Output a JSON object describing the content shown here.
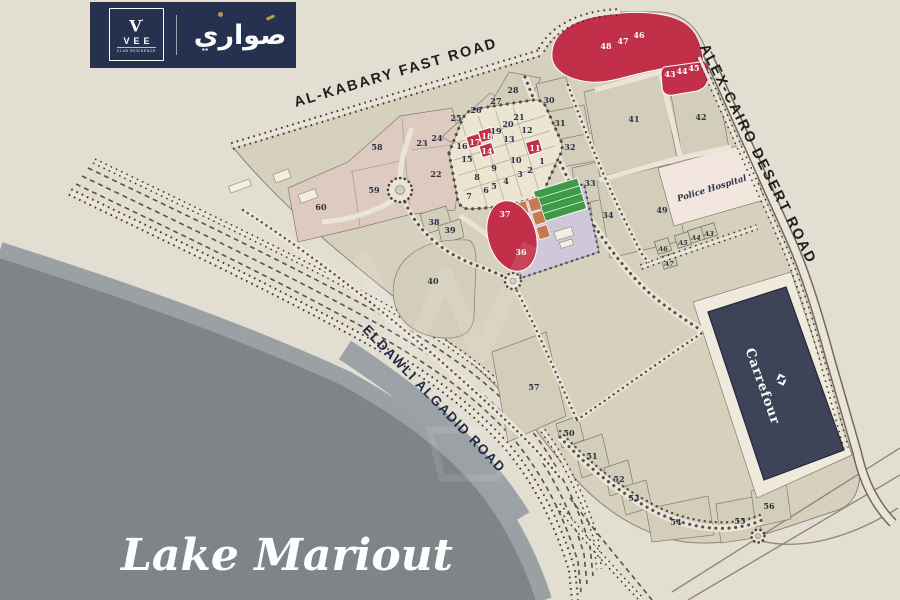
{
  "brand": {
    "vee_mark": "V",
    "vee_name": "VEE",
    "vee_subtitle": "CLUB RESIDENCE",
    "arabic_logo": "صواري"
  },
  "map": {
    "lake_label": "Lake Mariout",
    "roads": {
      "top": "AL-KABARY FAST ROAD",
      "right": "ALEX-CAIRO DESERT ROAD",
      "coast": "ELDAWLI ALGADID ROAD"
    },
    "landmarks": {
      "hospital": "Police Hospital",
      "hypermarket": "Carrefour"
    },
    "colors": {
      "highlight_red": "#c22f49",
      "plot_number_navy": "#2d3147",
      "lake_gray": "#7e8488",
      "land_beige": "#e3ded2",
      "building_navy": "#3e4457"
    },
    "plots": [
      {
        "id": "1",
        "x": 542,
        "y": 161
      },
      {
        "id": "2",
        "x": 530,
        "y": 170
      },
      {
        "id": "3",
        "x": 520,
        "y": 174
      },
      {
        "id": "4",
        "x": 506,
        "y": 181
      },
      {
        "id": "5",
        "x": 494,
        "y": 186
      },
      {
        "id": "6",
        "x": 486,
        "y": 190
      },
      {
        "id": "7",
        "x": 469,
        "y": 196
      },
      {
        "id": "8",
        "x": 477,
        "y": 177
      },
      {
        "id": "9",
        "x": 494,
        "y": 168
      },
      {
        "id": "10",
        "x": 516,
        "y": 160
      },
      {
        "id": "11",
        "x": 535,
        "y": 148,
        "red": true
      },
      {
        "id": "12",
        "x": 527,
        "y": 130
      },
      {
        "id": "13",
        "x": 509,
        "y": 139
      },
      {
        "id": "14",
        "x": 487,
        "y": 151,
        "red": true
      },
      {
        "id": "15",
        "x": 467,
        "y": 159
      },
      {
        "id": "16",
        "x": 462,
        "y": 146
      },
      {
        "id": "17",
        "x": 475,
        "y": 142,
        "red": true
      },
      {
        "id": "18",
        "x": 487,
        "y": 136,
        "red": true
      },
      {
        "id": "19",
        "x": 496,
        "y": 131
      },
      {
        "id": "20",
        "x": 508,
        "y": 124
      },
      {
        "id": "21",
        "x": 519,
        "y": 117
      },
      {
        "id": "22",
        "x": 436,
        "y": 174
      },
      {
        "id": "23",
        "x": 422,
        "y": 143
      },
      {
        "id": "24",
        "x": 437,
        "y": 138
      },
      {
        "id": "25",
        "x": 456,
        "y": 118
      },
      {
        "id": "26",
        "x": 476,
        "y": 110
      },
      {
        "id": "27",
        "x": 496,
        "y": 101
      },
      {
        "id": "28",
        "x": 513,
        "y": 90
      },
      {
        "id": "30",
        "x": 549,
        "y": 100
      },
      {
        "id": "31",
        "x": 560,
        "y": 123
      },
      {
        "id": "32",
        "x": 570,
        "y": 147
      },
      {
        "id": "33",
        "x": 590,
        "y": 183
      },
      {
        "id": "34",
        "x": 608,
        "y": 215
      },
      {
        "id": "36",
        "x": 521,
        "y": 252,
        "red": true
      },
      {
        "id": "37",
        "x": 505,
        "y": 214,
        "red": true
      },
      {
        "id": "38",
        "x": 434,
        "y": 222
      },
      {
        "id": "39",
        "x": 450,
        "y": 230
      },
      {
        "id": "40",
        "x": 433,
        "y": 281
      },
      {
        "id": "41",
        "x": 634,
        "y": 119
      },
      {
        "id": "42",
        "x": 701,
        "y": 117
      },
      {
        "id": "43",
        "x": 670,
        "y": 74,
        "red": true
      },
      {
        "id": "44",
        "x": 682,
        "y": 71,
        "red": true
      },
      {
        "id": "45",
        "x": 694,
        "y": 68,
        "red": true
      },
      {
        "id": "46",
        "x": 639,
        "y": 35,
        "red": true
      },
      {
        "id": "47",
        "x": 623,
        "y": 41,
        "red": true
      },
      {
        "id": "48",
        "x": 606,
        "y": 46,
        "red": true
      },
      {
        "id": "49",
        "x": 662,
        "y": 210
      },
      {
        "id": "50",
        "x": 569,
        "y": 433
      },
      {
        "id": "51",
        "x": 592,
        "y": 456
      },
      {
        "id": "52",
        "x": 619,
        "y": 479
      },
      {
        "id": "53",
        "x": 634,
        "y": 498
      },
      {
        "id": "54",
        "x": 676,
        "y": 522
      },
      {
        "id": "55",
        "x": 740,
        "y": 521
      },
      {
        "id": "56",
        "x": 769,
        "y": 506
      },
      {
        "id": "57",
        "x": 534,
        "y": 387
      },
      {
        "id": "58",
        "x": 377,
        "y": 147
      },
      {
        "id": "59",
        "x": 374,
        "y": 190
      },
      {
        "id": "60",
        "x": 321,
        "y": 207
      },
      {
        "id": "A3",
        "x": 709,
        "y": 233,
        "small": true
      },
      {
        "id": "A4",
        "x": 696,
        "y": 237,
        "small": true
      },
      {
        "id": "A5",
        "x": 683,
        "y": 242,
        "small": true
      },
      {
        "id": "A6",
        "x": 663,
        "y": 248,
        "small": true
      },
      {
        "id": "A7",
        "x": 669,
        "y": 263,
        "small": true
      }
    ]
  }
}
